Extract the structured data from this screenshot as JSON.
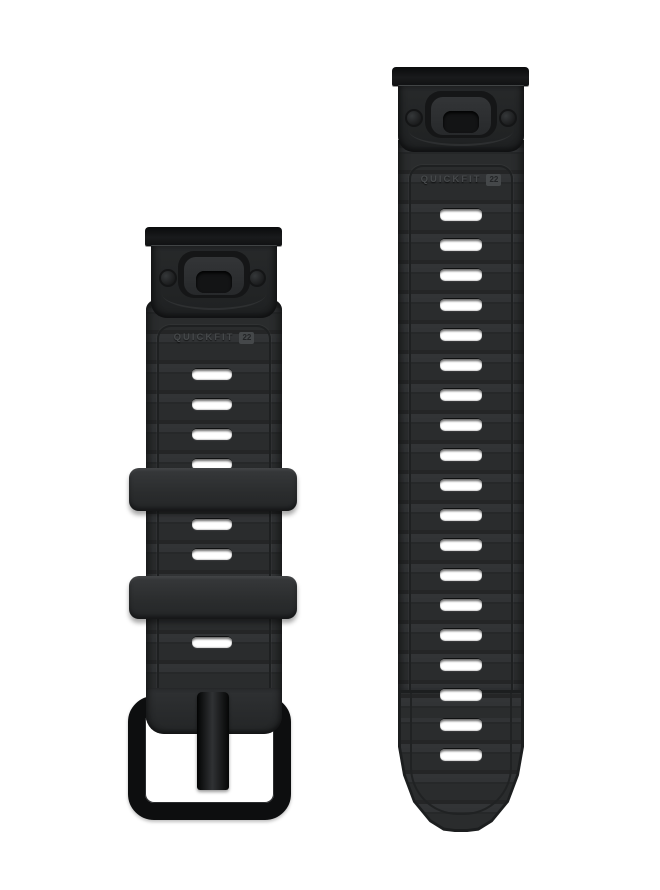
{
  "canvas": {
    "width": 660,
    "height": 890,
    "background": "#ffffff"
  },
  "colors": {
    "strap": "#2d2f31",
    "strap_edge": "#1d1f20",
    "connector_housing": "#242627",
    "connector_top_bar": "#131415",
    "keeper": "#2e3032",
    "buckle_hardware": "#0d0e0f",
    "adjustment_slot": "#ffffff",
    "embossed_label": "#46494b"
  },
  "short_band": {
    "label": "QUICKFIT",
    "size_badge": "22",
    "slot_count": 7,
    "slots_y": [
      368,
      398,
      428,
      458,
      518,
      548,
      636
    ],
    "keepers_y": [
      468,
      576
    ]
  },
  "long_band": {
    "label": "QUICKFIT",
    "size_badge": "22",
    "slot_count": 19,
    "slots_y": [
      208,
      238,
      268,
      298,
      328,
      358,
      388,
      418,
      448,
      478,
      508,
      538,
      568,
      598,
      628,
      658,
      688,
      718,
      748
    ]
  }
}
